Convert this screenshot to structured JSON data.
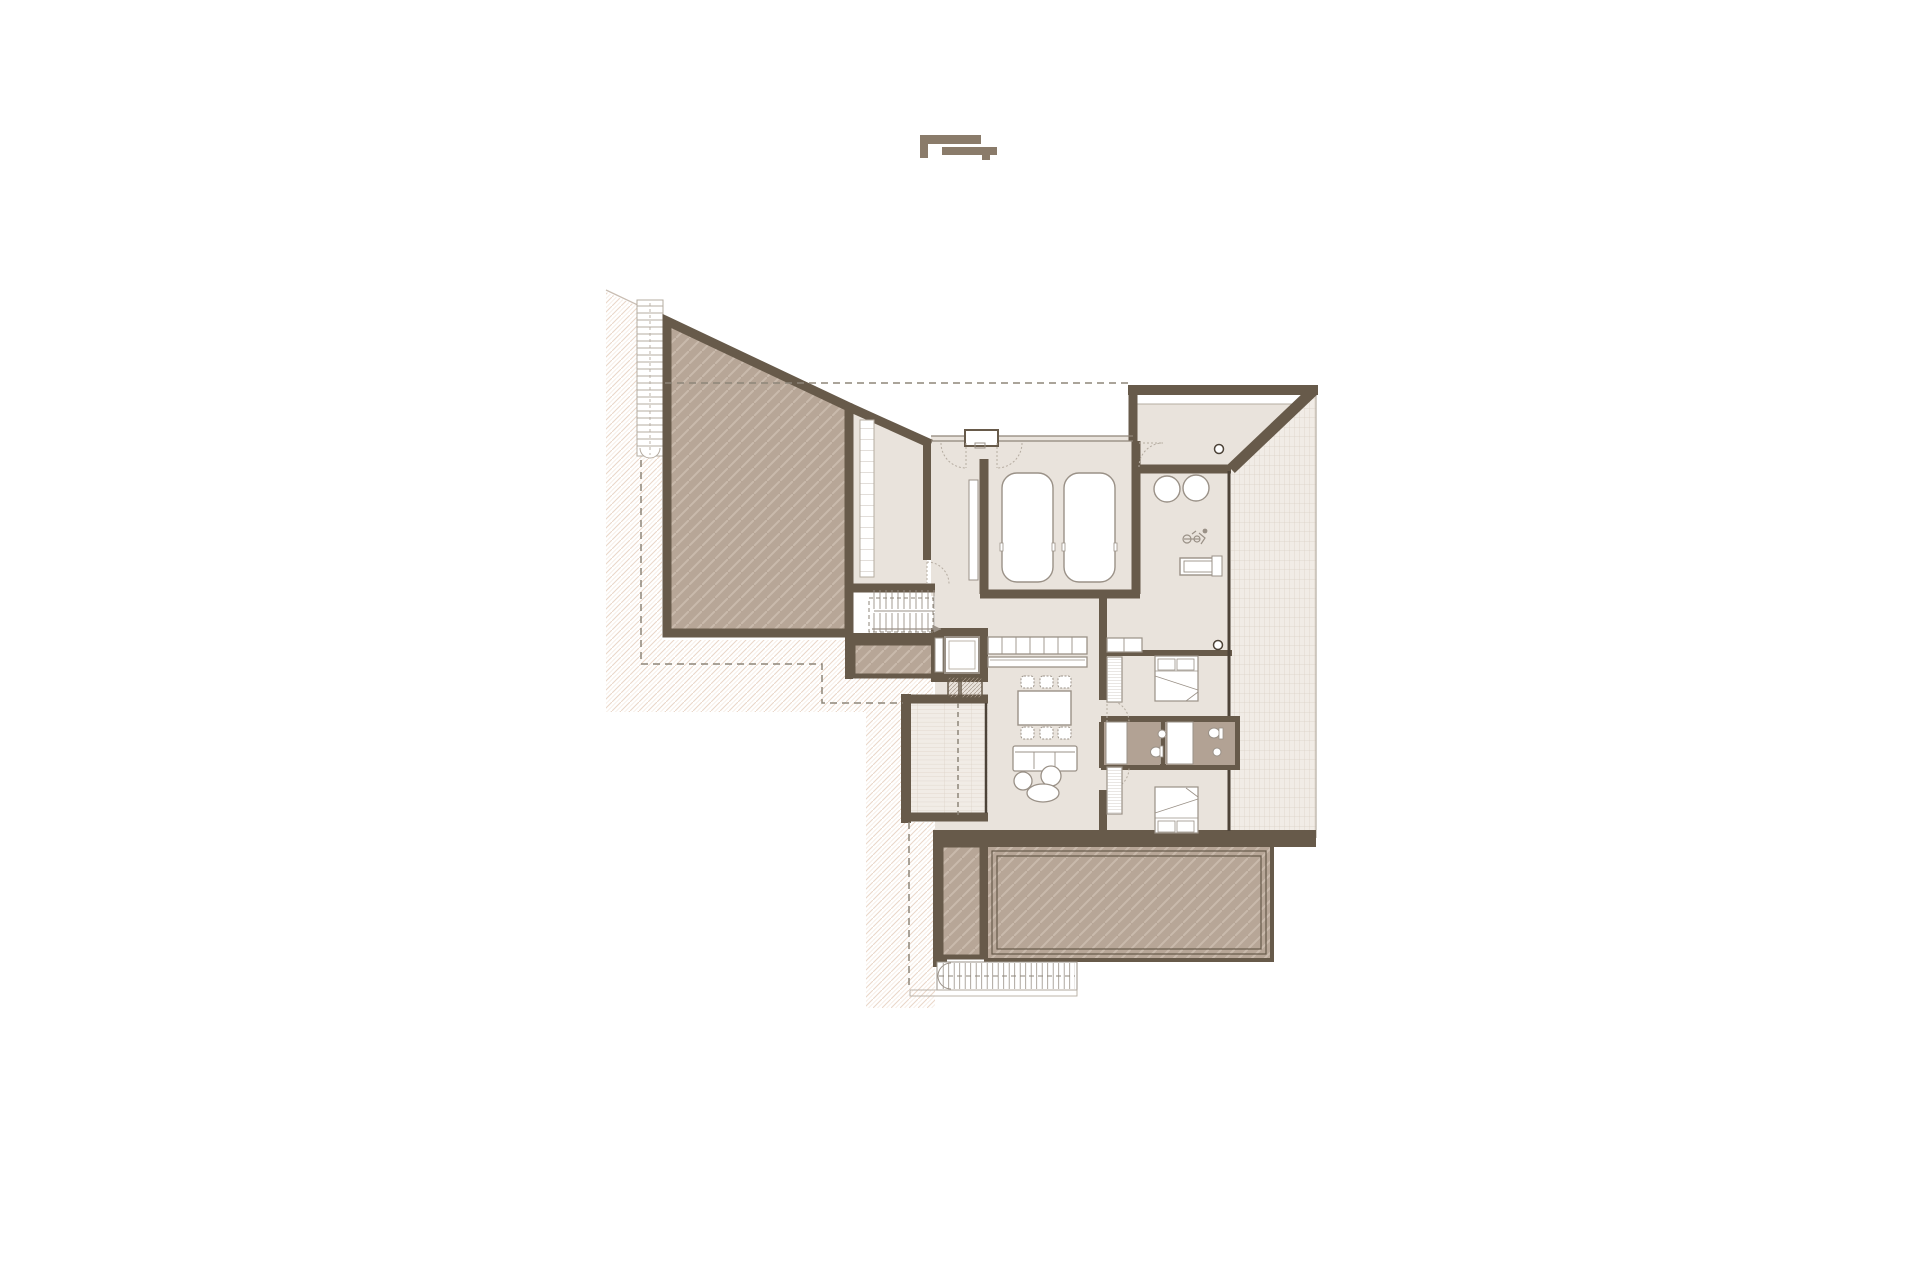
{
  "canvas": {
    "width": 1920,
    "height": 1280,
    "background": "#ffffff"
  },
  "palette": {
    "wall": "#675a4a",
    "wall_dark": "#4d4338",
    "roof_deck_fill": "#b7a697",
    "roof_deck_hatch": "#c9baac",
    "interior_floor": "#e9e3dc",
    "bathroom_floor": "#b2a294",
    "tile_base": "#f1ece6",
    "tile_line": "#dbd0c5",
    "site_hatch_line": "#ead7c9",
    "object_stroke": "#9a9187",
    "object_stroke_light": "#b5aca1",
    "dashed_line": "#8d8579",
    "logo": "#8a7b6a"
  },
  "drawing": {
    "kind": "architectural-floor-plan",
    "text_labels": [],
    "symbols": [
      "logo-mark",
      "site-hatching",
      "property-line-dashed",
      "roof-overhang-dashed",
      "exterior-stair",
      "roof-deck-trapezoid",
      "shelving-room",
      "internal-stair",
      "planter",
      "entry-double-door",
      "vestibule",
      "garage",
      "car",
      "car",
      "fitness-stools",
      "exercise-bike-icon",
      "workout-bench",
      "column",
      "kitchen-counter",
      "kitchen-island",
      "dining-table",
      "dining-chairs",
      "sofa",
      "pouf",
      "coffee-table",
      "balcony-planked",
      "chimney-flues",
      "bedroom-bed",
      "wardrobe",
      "bathroom",
      "toilet",
      "sink",
      "shower",
      "tiled-terrace",
      "terrace-deck",
      "terrace-planter",
      "drainage-grate"
    ]
  }
}
